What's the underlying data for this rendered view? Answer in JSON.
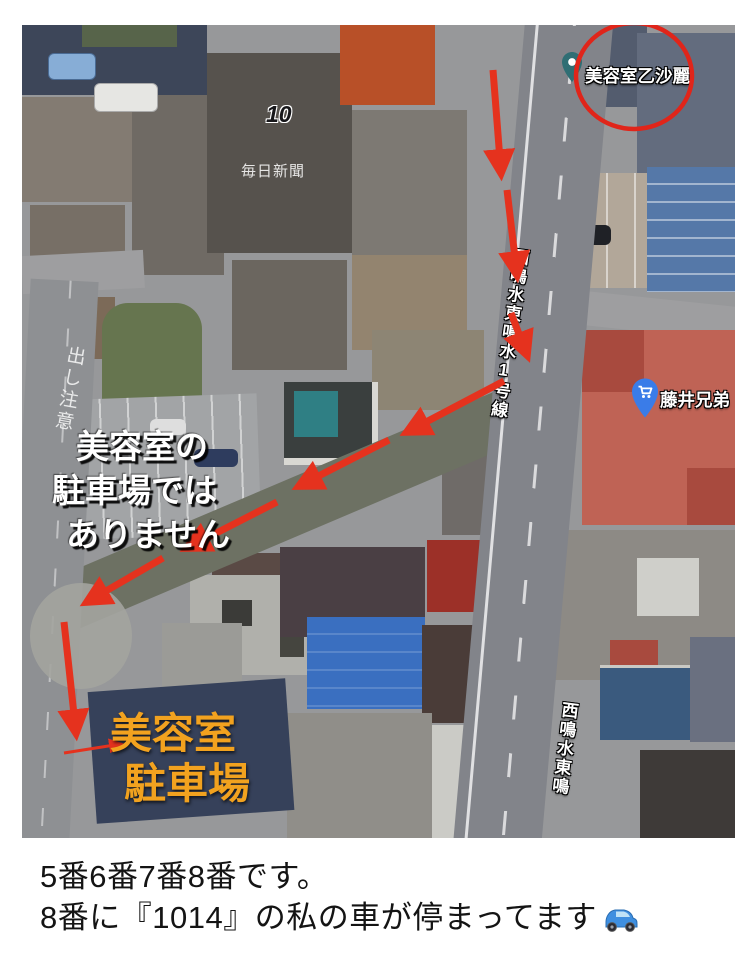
{
  "map": {
    "pins": [
      {
        "id": "salon",
        "label": "美容室乙沙麗"
      },
      {
        "id": "store",
        "label": "藤井兄弟"
      }
    ],
    "route_marker": "10",
    "building_label": "毎日新聞",
    "roads": {
      "main_name": "西鳴水東鳴水1号線",
      "bottom_name": "西鳴水東鳴",
      "paint": "出し注意"
    }
  },
  "annotations": {
    "not_parking": {
      "line1": "美容室の",
      "line2": "駐車場では",
      "line3": "ありません"
    },
    "salon_parking": {
      "line1": "美容室",
      "line2": "駐車場"
    }
  },
  "caption": {
    "line1": "5番6番7番8番です。",
    "line2": "8番に『1014』の私の車が停まってます",
    "car_emoji": "🚙"
  },
  "colors": {
    "arrow_red": "#e5321e",
    "circle_red": "#e0251a",
    "orange_text": "#f2a21f",
    "pin_teal": "#2f6e74",
    "pin_blue": "#3a7ce8"
  }
}
